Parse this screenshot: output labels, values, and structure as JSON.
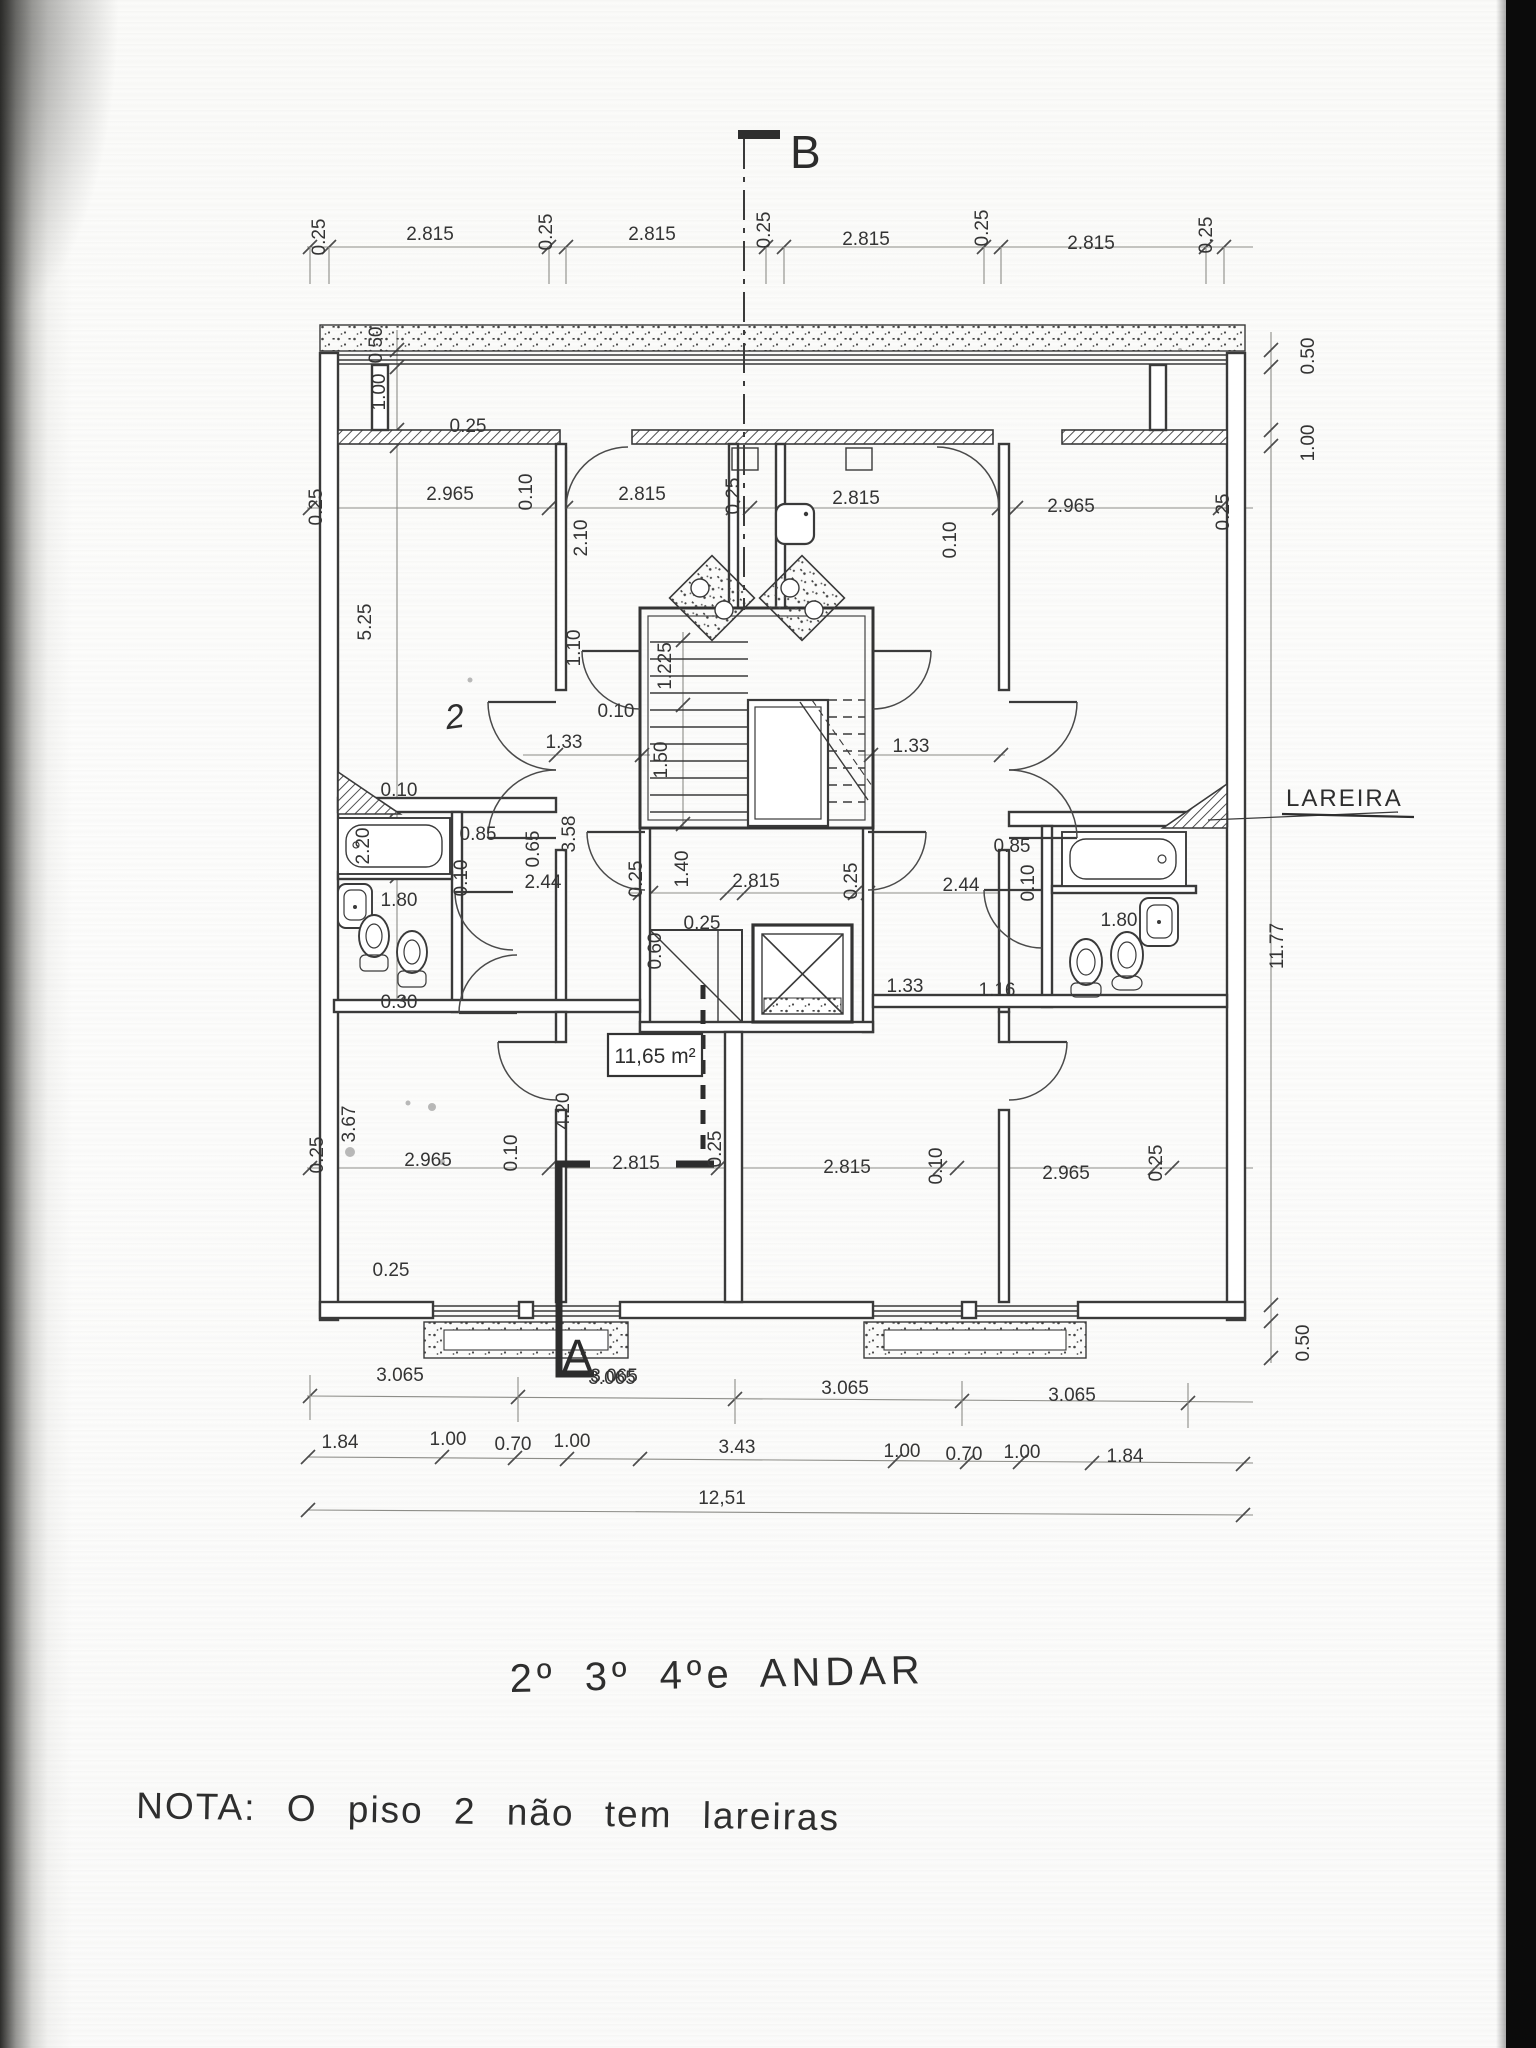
{
  "texts": {
    "floor_title": "2º 3º 4ºe ANDAR",
    "note": "NOTA: O piso 2 não tem lareiras"
  },
  "markers": {
    "a": "A",
    "b": "B"
  },
  "annotations": {
    "lareira": "LAREIRA",
    "area": "11,65 m²",
    "room_mark": "2"
  },
  "dimensions": {
    "top_chain": [
      {
        "t": "0.25",
        "x": 325,
        "y": 237,
        "r": -90
      },
      {
        "t": "2.815",
        "x": 430,
        "y": 240
      },
      {
        "t": "0.25",
        "x": 552,
        "y": 232,
        "r": -90
      },
      {
        "t": "2.815",
        "x": 652,
        "y": 240
      },
      {
        "t": "0.25",
        "x": 770,
        "y": 230,
        "r": -90
      },
      {
        "t": "2.815",
        "x": 866,
        "y": 245
      },
      {
        "t": "0.25",
        "x": 988,
        "y": 228,
        "r": -90
      },
      {
        "t": "2.815",
        "x": 1091,
        "y": 249
      },
      {
        "t": "0.25",
        "x": 1212,
        "y": 235,
        "r": -90
      }
    ],
    "left_side": [
      {
        "t": "0.50",
        "x": 382,
        "y": 345,
        "r": -90
      },
      {
        "t": "1.00",
        "x": 385,
        "y": 392,
        "r": -90
      },
      {
        "t": "5.25",
        "x": 371,
        "y": 622,
        "r": -90
      },
      {
        "t": "2.20",
        "x": 369,
        "y": 846,
        "r": -90
      },
      {
        "t": "0.10",
        "x": 399,
        "y": 796
      },
      {
        "t": "1.80",
        "x": 399,
        "y": 906
      },
      {
        "t": "0.30",
        "x": 399,
        "y": 1008
      },
      {
        "t": "3.67",
        "x": 355,
        "y": 1124,
        "r": -90
      },
      {
        "t": "0.25",
        "x": 323,
        "y": 1155,
        "r": -90
      },
      {
        "t": "0.25",
        "x": 391,
        "y": 1276
      }
    ],
    "upper_rooms_row": [
      {
        "t": "0.25",
        "x": 322,
        "y": 507,
        "r": -90
      },
      {
        "t": "2.965",
        "x": 450,
        "y": 500
      },
      {
        "t": "0.10",
        "x": 532,
        "y": 492,
        "r": -90
      },
      {
        "t": "2.815",
        "x": 642,
        "y": 500
      },
      {
        "t": "0.25",
        "x": 739,
        "y": 496,
        "r": -90
      },
      {
        "t": "2.815",
        "x": 856,
        "y": 504
      },
      {
        "t": "0.10",
        "x": 956,
        "y": 540,
        "r": -90
      },
      {
        "t": "2.965",
        "x": 1071,
        "y": 512
      },
      {
        "t": "0.25",
        "x": 1229,
        "y": 512,
        "r": -90
      },
      {
        "t": "2.10",
        "x": 587,
        "y": 538,
        "r": -90
      },
      {
        "t": "0.25",
        "x": 468,
        "y": 432
      }
    ],
    "stair_core": [
      {
        "t": "1.10",
        "x": 580,
        "y": 648,
        "r": -90
      },
      {
        "t": "1.225",
        "x": 671,
        "y": 666,
        "r": -90
      },
      {
        "t": "0.10",
        "x": 616,
        "y": 717
      },
      {
        "t": "1.33",
        "x": 564,
        "y": 748
      },
      {
        "t": "1.50",
        "x": 667,
        "y": 760,
        "r": -90
      },
      {
        "t": "1.33",
        "x": 911,
        "y": 752
      },
      {
        "t": "3.58",
        "x": 575,
        "y": 834,
        "r": -90
      },
      {
        "t": "0.65",
        "x": 539,
        "y": 849,
        "r": -90
      },
      {
        "t": "0.85",
        "x": 478,
        "y": 840
      },
      {
        "t": "2.44",
        "x": 543,
        "y": 888
      },
      {
        "t": "0.10",
        "x": 467,
        "y": 878,
        "r": -90
      }
    ],
    "center": [
      {
        "t": "0.25",
        "x": 642,
        "y": 879,
        "r": -90
      },
      {
        "t": "1.40",
        "x": 688,
        "y": 869,
        "r": -90
      },
      {
        "t": "2.815",
        "x": 756,
        "y": 887
      },
      {
        "t": "0.25",
        "x": 857,
        "y": 881,
        "r": -90
      },
      {
        "t": "2.44",
        "x": 961,
        "y": 891
      },
      {
        "t": "0.25",
        "x": 702,
        "y": 929
      },
      {
        "t": "0.60",
        "x": 661,
        "y": 951,
        "r": -90
      },
      {
        "t": "1.33",
        "x": 905,
        "y": 992
      },
      {
        "t": "1.16",
        "x": 997,
        "y": 996
      }
    ],
    "bath_right": [
      {
        "t": "0.85",
        "x": 1012,
        "y": 852
      },
      {
        "t": "0.10",
        "x": 1034,
        "y": 883,
        "r": -90
      },
      {
        "t": "1.80",
        "x": 1119,
        "y": 926
      }
    ],
    "right_side": [
      {
        "t": "0.50",
        "x": 1314,
        "y": 356,
        "r": -90
      },
      {
        "t": "1.00",
        "x": 1314,
        "y": 443,
        "r": -90
      },
      {
        "t": "11.77",
        "x": 1283,
        "y": 946,
        "r": -90
      },
      {
        "t": "0.50",
        "x": 1309,
        "y": 1343,
        "r": -90
      }
    ],
    "lower_rooms_row": [
      {
        "t": "2.965",
        "x": 428,
        "y": 1166
      },
      {
        "t": "0.10",
        "x": 517,
        "y": 1153,
        "r": -90
      },
      {
        "t": "4.20",
        "x": 569,
        "y": 1111,
        "r": -90
      },
      {
        "t": "2.815",
        "x": 636,
        "y": 1169
      },
      {
        "t": "0.25",
        "x": 721,
        "y": 1149,
        "r": -90
      },
      {
        "t": "2.815",
        "x": 847,
        "y": 1173
      },
      {
        "t": "0.10",
        "x": 942,
        "y": 1166,
        "r": -90
      },
      {
        "t": "2.965",
        "x": 1066,
        "y": 1179
      },
      {
        "t": "0.25",
        "x": 1162,
        "y": 1163,
        "r": -90
      }
    ],
    "bottom_chains": [
      {
        "t": "3.065",
        "x": 400,
        "y": 1381
      },
      {
        "t": "3.065",
        "x": 612,
        "y": 1384
      },
      {
        "t": "3.065",
        "x": 845,
        "y": 1394
      },
      {
        "t": "3.065",
        "x": 1072,
        "y": 1401
      },
      {
        "t": "3.065",
        "x": 614,
        "y": 1382
      },
      {
        "t": "1.84",
        "x": 340,
        "y": 1448
      },
      {
        "t": "1.00",
        "x": 448,
        "y": 1445
      },
      {
        "t": "0.70",
        "x": 513,
        "y": 1450
      },
      {
        "t": "1.00",
        "x": 572,
        "y": 1447
      },
      {
        "t": "3.43",
        "x": 737,
        "y": 1453
      },
      {
        "t": "1.00",
        "x": 902,
        "y": 1457
      },
      {
        "t": "0.70",
        "x": 964,
        "y": 1460
      },
      {
        "t": "1.00",
        "x": 1022,
        "y": 1458
      },
      {
        "t": "1.84",
        "x": 1125,
        "y": 1462
      },
      {
        "t": "12,51",
        "x": 722,
        "y": 1504
      }
    ]
  }
}
